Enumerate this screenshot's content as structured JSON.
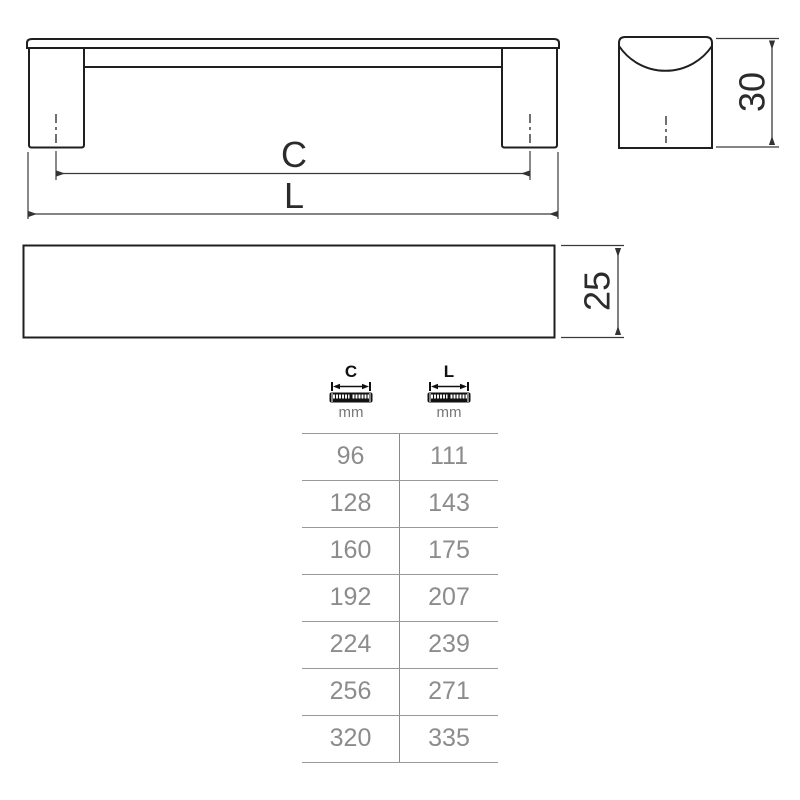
{
  "drawing": {
    "front_view": {
      "label_c": "C",
      "label_l": "L"
    },
    "side_view": {
      "height_label": "30"
    },
    "plan_view": {
      "depth_label": "25"
    }
  },
  "table": {
    "columns": [
      {
        "letter": "C",
        "unit": "mm"
      },
      {
        "letter": "L",
        "unit": "mm"
      }
    ],
    "rows": [
      {
        "c": "96",
        "l": "111"
      },
      {
        "c": "128",
        "l": "143"
      },
      {
        "c": "160",
        "l": "175"
      },
      {
        "c": "192",
        "l": "207"
      },
      {
        "c": "224",
        "l": "239"
      },
      {
        "c": "256",
        "l": "271"
      },
      {
        "c": "320",
        "l": "335"
      }
    ]
  },
  "colors": {
    "outline": "#1f1f1f",
    "dimension_line": "#3a3a3a",
    "table_line": "#999999",
    "table_text": "#8c8c8c",
    "icon_black": "#111111"
  }
}
